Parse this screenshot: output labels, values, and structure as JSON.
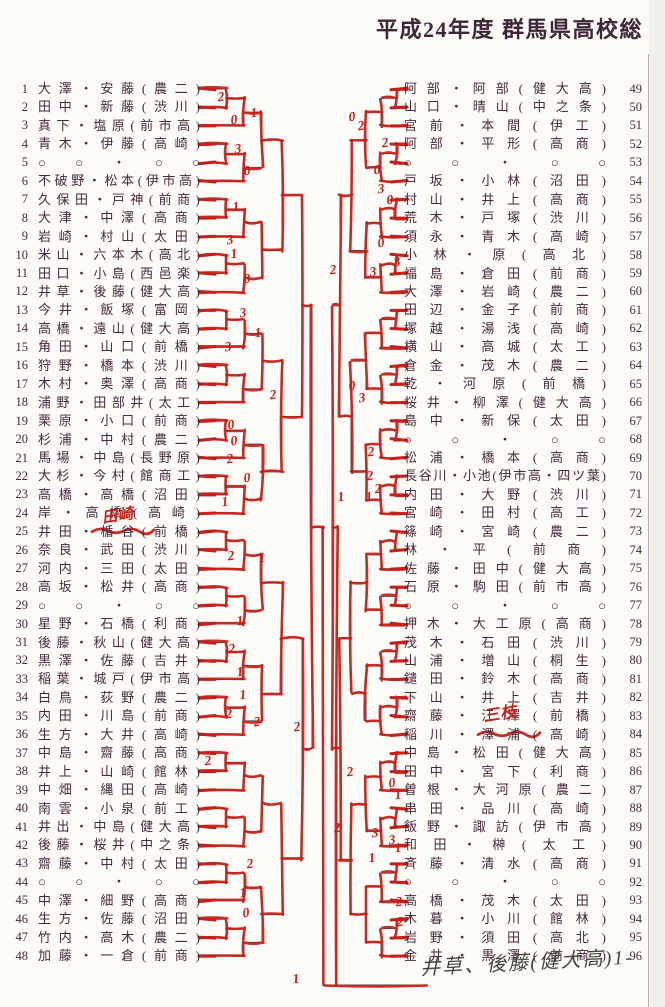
{
  "title": "平成24年度 群馬県高校総",
  "colors": {
    "ink": "#46293e",
    "red": "#c5201a",
    "printed_line": "#4a4550"
  },
  "bracket": {
    "left_entries": [
      {
        "no": "1",
        "name": "大澤・安藤(農二)"
      },
      {
        "no": "2",
        "name": "田中・新藤(渋川)"
      },
      {
        "no": "3",
        "name": "真下・塩原(前市高)"
      },
      {
        "no": "4",
        "name": "青木・伊藤(高崎)"
      },
      {
        "no": "5",
        "name": "○○・○○"
      },
      {
        "no": "6",
        "name": "不破野・松本(伊市高)"
      },
      {
        "no": "7",
        "name": "久保田・戸神(前商)"
      },
      {
        "no": "8",
        "name": "大津・中澤(高商)"
      },
      {
        "no": "9",
        "name": "岩崎・村山(太田)"
      },
      {
        "no": "10",
        "name": "米山・六本木(高北)"
      },
      {
        "no": "11",
        "name": "田口・小島(西邑楽)"
      },
      {
        "no": "12",
        "name": "井草・後藤(健大高)"
      },
      {
        "no": "13",
        "name": "今井・飯塚(富岡)"
      },
      {
        "no": "14",
        "name": "高橋・遠山(健大高)"
      },
      {
        "no": "15",
        "name": "角田・山口(前橋)"
      },
      {
        "no": "16",
        "name": "狩野・橋本(渋川)"
      },
      {
        "no": "17",
        "name": "木村・奥澤(高商)"
      },
      {
        "no": "18",
        "name": "浦野・田部井(太工)"
      },
      {
        "no": "19",
        "name": "栗原・小口(前商)"
      },
      {
        "no": "20",
        "name": "杉浦・中村(農二)"
      },
      {
        "no": "21",
        "name": "馬場・中島(長野原)"
      },
      {
        "no": "22",
        "name": "大杉・今村(館商工)"
      },
      {
        "no": "23",
        "name": "高橋・高橋(沼田)"
      },
      {
        "no": "24",
        "name": "岸・高橋(高崎)"
      },
      {
        "no": "25",
        "name": "井田・楯谷(前橋)",
        "scribble": true
      },
      {
        "no": "26",
        "name": "奈良・武田(渋川)"
      },
      {
        "no": "27",
        "name": "河内・三田(太田)"
      },
      {
        "no": "28",
        "name": "高坂・松井(高商)"
      },
      {
        "no": "29",
        "name": "○○・○○"
      },
      {
        "no": "30",
        "name": "星野・石橋(利商)"
      },
      {
        "no": "31",
        "name": "後藤・秋山(健大高)"
      },
      {
        "no": "32",
        "name": "黒澤・佐藤(吉井)"
      },
      {
        "no": "33",
        "name": "稲葉・城戸(伊市高)"
      },
      {
        "no": "34",
        "name": "白鳥・荻野(農二)"
      },
      {
        "no": "35",
        "name": "内田・川島(前商)"
      },
      {
        "no": "36",
        "name": "生方・大井(高崎)"
      },
      {
        "no": "37",
        "name": "中島・齋藤(高商)"
      },
      {
        "no": "38",
        "name": "井上・山崎(館林)"
      },
      {
        "no": "39",
        "name": "中畑・縄田(高崎)"
      },
      {
        "no": "40",
        "name": "南雲・小泉(前工)"
      },
      {
        "no": "41",
        "name": "井出・中島(健大高)"
      },
      {
        "no": "42",
        "name": "後藤・桜井(中之条)"
      },
      {
        "no": "43",
        "name": "齋藤・中村(太田)"
      },
      {
        "no": "44",
        "name": "○○・○○"
      },
      {
        "no": "45",
        "name": "中澤・細野(高商)"
      },
      {
        "no": "46",
        "name": "生方・佐藤(沼田)"
      },
      {
        "no": "47",
        "name": "竹内・高木(農二)"
      },
      {
        "no": "48",
        "name": "加藤・一倉(前商)"
      }
    ],
    "right_entries": [
      {
        "no": "49",
        "name": "阿部・阿部(健大高)"
      },
      {
        "no": "50",
        "name": "山口・晴山(中之条)"
      },
      {
        "no": "51",
        "name": "宮前・本間(伊工)"
      },
      {
        "no": "52",
        "name": "阿部・平形(高商)"
      },
      {
        "no": "53",
        "name": "○○・○○"
      },
      {
        "no": "54",
        "name": "戸坂・小林(沼田)"
      },
      {
        "no": "55",
        "name": "村山・井上(高商)"
      },
      {
        "no": "56",
        "name": "荒木・戸塚(渋川)"
      },
      {
        "no": "57",
        "name": "須永・青木(高崎)"
      },
      {
        "no": "58",
        "name": "小林・原(高北)"
      },
      {
        "no": "59",
        "name": "福島・倉田(前商)"
      },
      {
        "no": "60",
        "name": "大澤・岩崎(農二)"
      },
      {
        "no": "61",
        "name": "田辺・金子(前商)"
      },
      {
        "no": "62",
        "name": "塚越・湯浅(高崎)"
      },
      {
        "no": "63",
        "name": "横山・高城(太工)"
      },
      {
        "no": "64",
        "name": "倉金・茂木(農二)"
      },
      {
        "no": "65",
        "name": "乾・河原(前橋)"
      },
      {
        "no": "66",
        "name": "桜井・柳澤(健大高)"
      },
      {
        "no": "67",
        "name": "島中・新保(太田)"
      },
      {
        "no": "68",
        "name": "○○・○○"
      },
      {
        "no": "69",
        "name": "松浦・橋本(高商)"
      },
      {
        "no": "70",
        "name": "長谷川・小池(伊市高・四ツ葉)"
      },
      {
        "no": "71",
        "name": "内田・大野(渋川)"
      },
      {
        "no": "72",
        "name": "宮崎・田村(高工)"
      },
      {
        "no": "73",
        "name": "篠崎・宮崎(農二)"
      },
      {
        "no": "74",
        "name": "林・平(前商)"
      },
      {
        "no": "75",
        "name": "佐藤・田中(健大高)"
      },
      {
        "no": "76",
        "name": "石原・駒田(前市高)"
      },
      {
        "no": "77",
        "name": "○○・○○"
      },
      {
        "no": "78",
        "name": "押木・大工原(高商)"
      },
      {
        "no": "79",
        "name": "茂木・石田(渋川)"
      },
      {
        "no": "80",
        "name": "山浦・増山(桐生)"
      },
      {
        "no": "81",
        "name": "鑓田・鈴木(高商)"
      },
      {
        "no": "82",
        "name": "下山・井上(吉井)"
      },
      {
        "no": "83",
        "name": "齋藤・江澤(前橋)"
      },
      {
        "no": "84",
        "name": "稲川・澤浦(高崎)",
        "scribble": true
      },
      {
        "no": "85",
        "name": "中島・松田(健大高)"
      },
      {
        "no": "86",
        "name": "田中・宮下(利商)"
      },
      {
        "no": "87",
        "name": "曽根・大河原(農二)"
      },
      {
        "no": "88",
        "name": "串田・品川(高崎)"
      },
      {
        "no": "89",
        "name": "飯野・諏訪(伊市高)"
      },
      {
        "no": "90",
        "name": "和田・榊(太工)"
      },
      {
        "no": "91",
        "name": "斉藤・清水(高商)"
      },
      {
        "no": "92",
        "name": "○○・○○"
      },
      {
        "no": "93",
        "name": "高橋・茂木(太田)"
      },
      {
        "no": "94",
        "name": "木暮・小川(館林)"
      },
      {
        "no": "95",
        "name": "岩野・須田(高北)"
      },
      {
        "no": "96",
        "name": "金井・黒澤(前商)"
      }
    ]
  },
  "annotations": {
    "winner_note": "井草、後藤(健大高)1-",
    "corrections": [
      {
        "x": 118,
        "y": 515,
        "text": "田崎",
        "size": 15
      },
      {
        "x": 500,
        "y": 712,
        "text": "三枝",
        "size": 16
      }
    ],
    "scores": [
      {
        "x": 221,
        "y": 97,
        "v": "2"
      },
      {
        "x": 234,
        "y": 120,
        "v": "0"
      },
      {
        "x": 254,
        "y": 113,
        "v": "1"
      },
      {
        "x": 238,
        "y": 149,
        "v": "3"
      },
      {
        "x": 247,
        "y": 171,
        "v": "0"
      },
      {
        "x": 236,
        "y": 207,
        "v": "1"
      },
      {
        "x": 230,
        "y": 240,
        "v": "3"
      },
      {
        "x": 234,
        "y": 254,
        "v": "1"
      },
      {
        "x": 247,
        "y": 279,
        "v": "0"
      },
      {
        "x": 243,
        "y": 313,
        "v": "3"
      },
      {
        "x": 258,
        "y": 333,
        "v": "1"
      },
      {
        "x": 228,
        "y": 347,
        "v": "3"
      },
      {
        "x": 273,
        "y": 395,
        "v": "2"
      },
      {
        "x": 231,
        "y": 425,
        "v": "0"
      },
      {
        "x": 234,
        "y": 441,
        "v": "0"
      },
      {
        "x": 230,
        "y": 459,
        "v": "2"
      },
      {
        "x": 247,
        "y": 478,
        "v": "0"
      },
      {
        "x": 225,
        "y": 502,
        "v": "1"
      },
      {
        "x": 231,
        "y": 556,
        "v": "2"
      },
      {
        "x": 262,
        "y": 558,
        "v": "1"
      },
      {
        "x": 240,
        "y": 621,
        "v": "1"
      },
      {
        "x": 232,
        "y": 649,
        "v": "2"
      },
      {
        "x": 240,
        "y": 672,
        "v": "1"
      },
      {
        "x": 243,
        "y": 695,
        "v": "1"
      },
      {
        "x": 229,
        "y": 714,
        "v": "2"
      },
      {
        "x": 257,
        "y": 722,
        "v": "2"
      },
      {
        "x": 297,
        "y": 727,
        "v": "2"
      },
      {
        "x": 208,
        "y": 761,
        "v": "2"
      },
      {
        "x": 250,
        "y": 864,
        "v": "2"
      },
      {
        "x": 243,
        "y": 893,
        "v": "1"
      },
      {
        "x": 246,
        "y": 913,
        "v": "0"
      },
      {
        "x": 352,
        "y": 117,
        "v": "0"
      },
      {
        "x": 361,
        "y": 126,
        "v": "2"
      },
      {
        "x": 385,
        "y": 143,
        "v": "2"
      },
      {
        "x": 377,
        "y": 170,
        "v": "0"
      },
      {
        "x": 381,
        "y": 189,
        "v": "3"
      },
      {
        "x": 390,
        "y": 200,
        "v": "0"
      },
      {
        "x": 381,
        "y": 243,
        "v": "0"
      },
      {
        "x": 397,
        "y": 262,
        "v": "3"
      },
      {
        "x": 373,
        "y": 272,
        "v": "3"
      },
      {
        "x": 333,
        "y": 270,
        "v": "2"
      },
      {
        "x": 352,
        "y": 386,
        "v": "0"
      },
      {
        "x": 362,
        "y": 398,
        "v": "3"
      },
      {
        "x": 371,
        "y": 452,
        "v": "2"
      },
      {
        "x": 370,
        "y": 476,
        "v": "2"
      },
      {
        "x": 378,
        "y": 489,
        "v": "2"
      },
      {
        "x": 341,
        "y": 497,
        "v": "1"
      },
      {
        "x": 369,
        "y": 497,
        "v": "1"
      },
      {
        "x": 350,
        "y": 772,
        "v": "2"
      },
      {
        "x": 392,
        "y": 783,
        "v": "0"
      },
      {
        "x": 398,
        "y": 795,
        "v": "1"
      },
      {
        "x": 337,
        "y": 828,
        "v": "2"
      },
      {
        "x": 375,
        "y": 833,
        "v": "3"
      },
      {
        "x": 392,
        "y": 840,
        "v": "3"
      },
      {
        "x": 398,
        "y": 848,
        "v": "1"
      },
      {
        "x": 372,
        "y": 858,
        "v": "1"
      },
      {
        "x": 399,
        "y": 902,
        "v": "2"
      },
      {
        "x": 400,
        "y": 922,
        "v": "2"
      },
      {
        "x": 296,
        "y": 979,
        "v": "1"
      }
    ]
  }
}
